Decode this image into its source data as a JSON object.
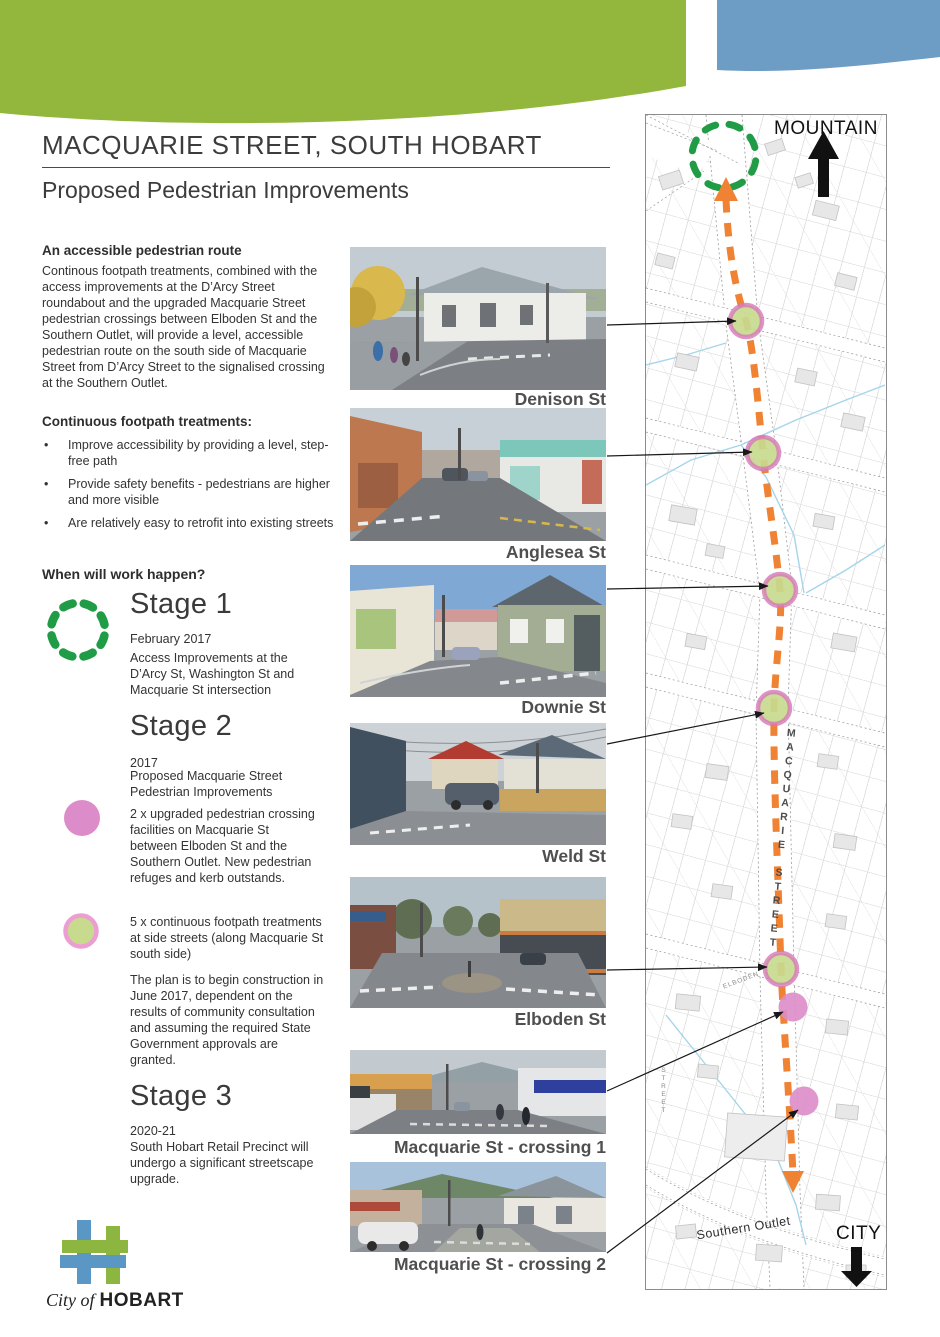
{
  "header": {
    "title": "MACQUARIE STREET, SOUTH HOBART",
    "subtitle": "Proposed Pedestrian Improvements"
  },
  "intro": {
    "heading": "An accessible pedestrian route",
    "body": "Continous footpath treatments, combined with the access improvements at the D’Arcy Street roundabout and the upgraded Macquarie Street pedestrian crossings between Elboden St and the Southern Outlet, will provide a level, accessible pedestrian route on the south side of Macquarie Street from D’Arcy Street to the signalised crossing at the Southern Outlet."
  },
  "treatments": {
    "heading": "Continuous footpath treatments:",
    "bullets": [
      "Improve accessibility by providing a level, step-free path",
      "Provide safety benefits - pedestrians are higher and more visible",
      "Are relatively easy to retrofit into existing streets"
    ]
  },
  "schedule": {
    "heading": "When will work happen?",
    "stage1": {
      "name": "Stage 1",
      "date": "February 2017",
      "description": "Access Improvements at the D’Arcy St, Washington St and Macquarie St intersection"
    },
    "stage2": {
      "name": "Stage 2",
      "date": "2017",
      "intro": "Proposed Macquarie Street Pedestrian Improvements",
      "crossings_item": "2 x upgraded pedestrian crossing facilities on Macquarie St between Elboden St and the Southern Outlet. New pedestrian refuges and kerb outstands.",
      "footpath_item": "5 x continuous footpath treatments at side streets (along Macquarie St south side)",
      "note": "The plan is to begin construction in June 2017, dependent on the results of community consultation and assuming the required State Government approvals are granted."
    },
    "stage3": {
      "name": "Stage 3",
      "date": "2020-21",
      "description": "South Hobart Retail Precinct will undergo a significant streetscape upgrade."
    }
  },
  "photos": [
    {
      "label": "Denison St"
    },
    {
      "label": "Anglesea St"
    },
    {
      "label": "Downie St"
    },
    {
      "label": "Weld St"
    },
    {
      "label": "Elboden St"
    },
    {
      "label": "Macquarie St - crossing 1"
    },
    {
      "label": "Macquarie St - crossing 2"
    }
  ],
  "map": {
    "mountain_label": "MOUNTAIN",
    "city_label": "CITY",
    "street_name": "MACQUARIE STREET",
    "southern_outlet_label": "Southern Outlet",
    "elboden_label": "ELBODEN",
    "side_street_label": "STREET"
  },
  "footer": {
    "city_of": "City of",
    "hobart": "HOBART"
  },
  "colors": {
    "header_green": "#92b73c",
    "header_blue": "#6d9dc4",
    "route_orange": "#f08233",
    "stage1_dash_green": "#1f9c45",
    "crossing_pink": "#dc8cc8",
    "treatment_fill": "#c8da8e",
    "treatment_ring": "#d678b8"
  }
}
